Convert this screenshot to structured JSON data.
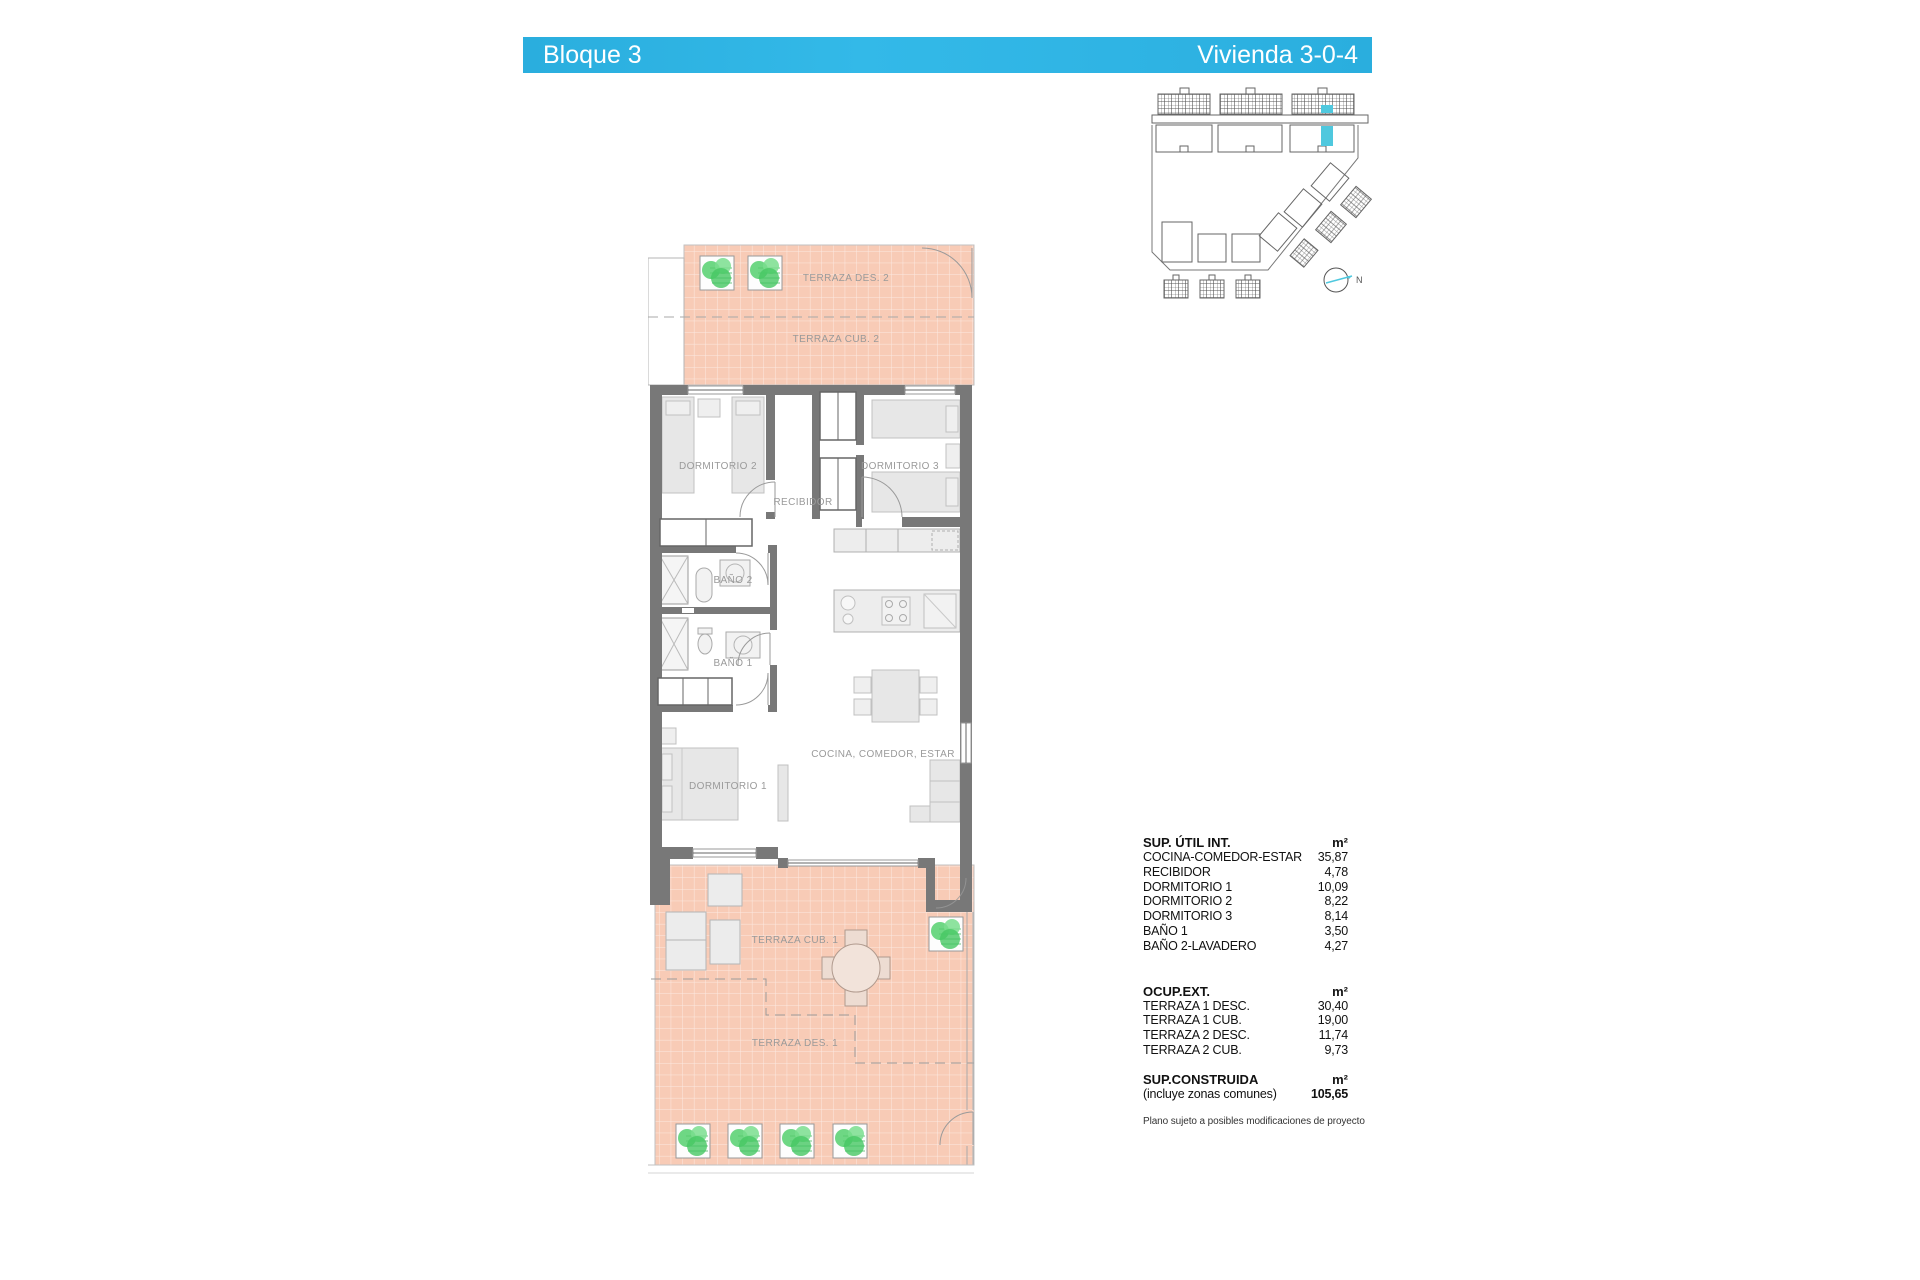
{
  "header": {
    "left_label": "Bloque 3",
    "right_label": "Vivienda 3-0-4",
    "accent_color": "#2FB3E4"
  },
  "plan": {
    "labels": {
      "terraza_des_2": "TERRAZA DES. 2",
      "terraza_cub_2": "TERRAZA CUB. 2",
      "dormitorio_2": "DORMITORIO 2",
      "dormitorio_3": "DORMITORIO 3",
      "recibidor": "RECIBIDOR",
      "bano_2": "BAÑO 2",
      "bano_1": "BAÑO 1",
      "dormitorio_1": "DORMITORIO 1",
      "cocina": "COCINA, COMEDOR, ESTAR",
      "terraza_cub_1": "TERRAZA CUB. 1",
      "terraza_des_1": "TERRAZA DES. 1"
    },
    "terrace_color": "#F8CBB6",
    "wall_color": "#787878"
  },
  "site_plan": {
    "north_label": "N",
    "highlight_color": "#4FC8DE"
  },
  "tables": {
    "util": {
      "title": "SUP. ÚTIL INT.",
      "unit": "m²",
      "rows": [
        {
          "label": "COCINA-COMEDOR-ESTAR",
          "value": "35,87"
        },
        {
          "label": "RECIBIDOR",
          "value": "4,78"
        },
        {
          "label": "DORMITORIO 1",
          "value": "10,09"
        },
        {
          "label": "DORMITORIO 2",
          "value": "8,22"
        },
        {
          "label": "DORMITORIO 3",
          "value": "8,14"
        },
        {
          "label": "BAÑO 1",
          "value": "3,50"
        },
        {
          "label": "BAÑO 2-LAVADERO",
          "value": "4,27"
        }
      ]
    },
    "ext": {
      "title": "OCUP.EXT.",
      "unit": "m²",
      "rows": [
        {
          "label": "TERRAZA 1 DESC.",
          "value": "30,40"
        },
        {
          "label": "TERRAZA 1 CUB.",
          "value": "19,00"
        },
        {
          "label": "TERRAZA 2 DESC.",
          "value": "11,74"
        },
        {
          "label": "TERRAZA 2 CUB.",
          "value": "9,73"
        }
      ]
    },
    "construida": {
      "title": "SUP.CONSTRUIDA",
      "unit": "m²",
      "note": "(incluye zonas comunes)",
      "value": "105,65"
    }
  },
  "footnote": "Plano sujeto a posibles modificaciones de proyecto"
}
